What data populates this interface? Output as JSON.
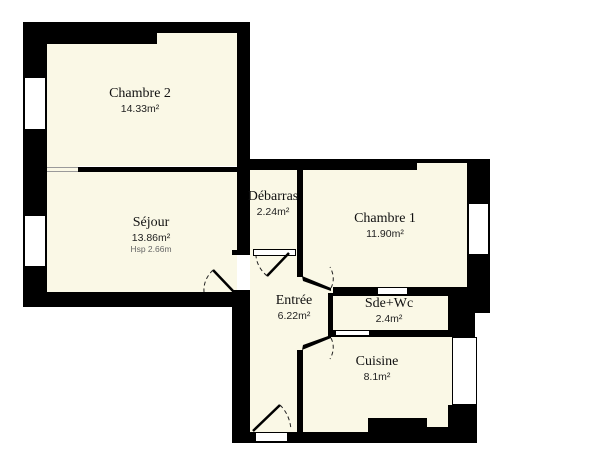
{
  "plan": {
    "type": "apartment-floorplan",
    "colors": {
      "background": "#ffffff",
      "room_fill": "#faf8e6",
      "wall": "#000000",
      "door_arc": "#222222",
      "ceiling_text": "#666666"
    },
    "rooms": [
      {
        "id": "chambre2",
        "name": "Chambre 2",
        "area": "14.33m²"
      },
      {
        "id": "sejour",
        "name": "Séjour",
        "area": "13.86m²",
        "hsp": "Hsp 2.66m"
      },
      {
        "id": "debarras",
        "name": "Débarras",
        "area": "2.24m²"
      },
      {
        "id": "chambre1",
        "name": "Chambre 1",
        "area": "11.90m²"
      },
      {
        "id": "entree",
        "name": "Entrée",
        "area": "6.22m²"
      },
      {
        "id": "sdewc",
        "name": "Sde+Wc",
        "area": "2.4m²"
      },
      {
        "id": "cuisine",
        "name": "Cuisine",
        "area": "8.1m²"
      }
    ]
  }
}
